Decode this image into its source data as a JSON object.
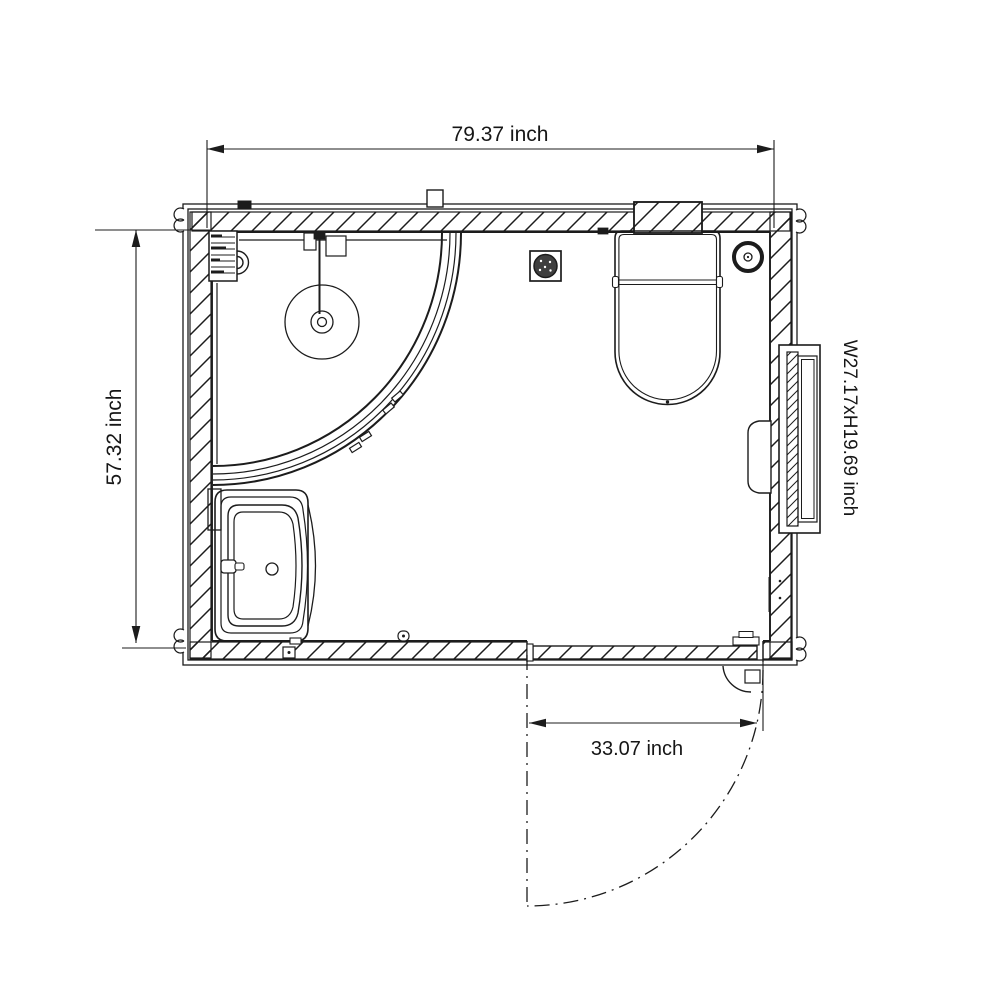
{
  "title": "bathroom-unit-floor-plan",
  "labels": {
    "overall_width": "79.37 inch",
    "overall_depth": "57.32 inch",
    "door_opening_width": "33.07 inch",
    "window_size": "W27.17xH19.69 inch"
  },
  "colors": {
    "line": "#1c1c1c",
    "background": "#ffffff",
    "drain_fill": "#3f3f3f"
  },
  "fixtures": [
    "corner-shower-enclosure",
    "shower-head",
    "wall-grille",
    "washbasin",
    "toilet",
    "floor-drain",
    "ventilation-fan",
    "side-window",
    "hinged-door"
  ]
}
